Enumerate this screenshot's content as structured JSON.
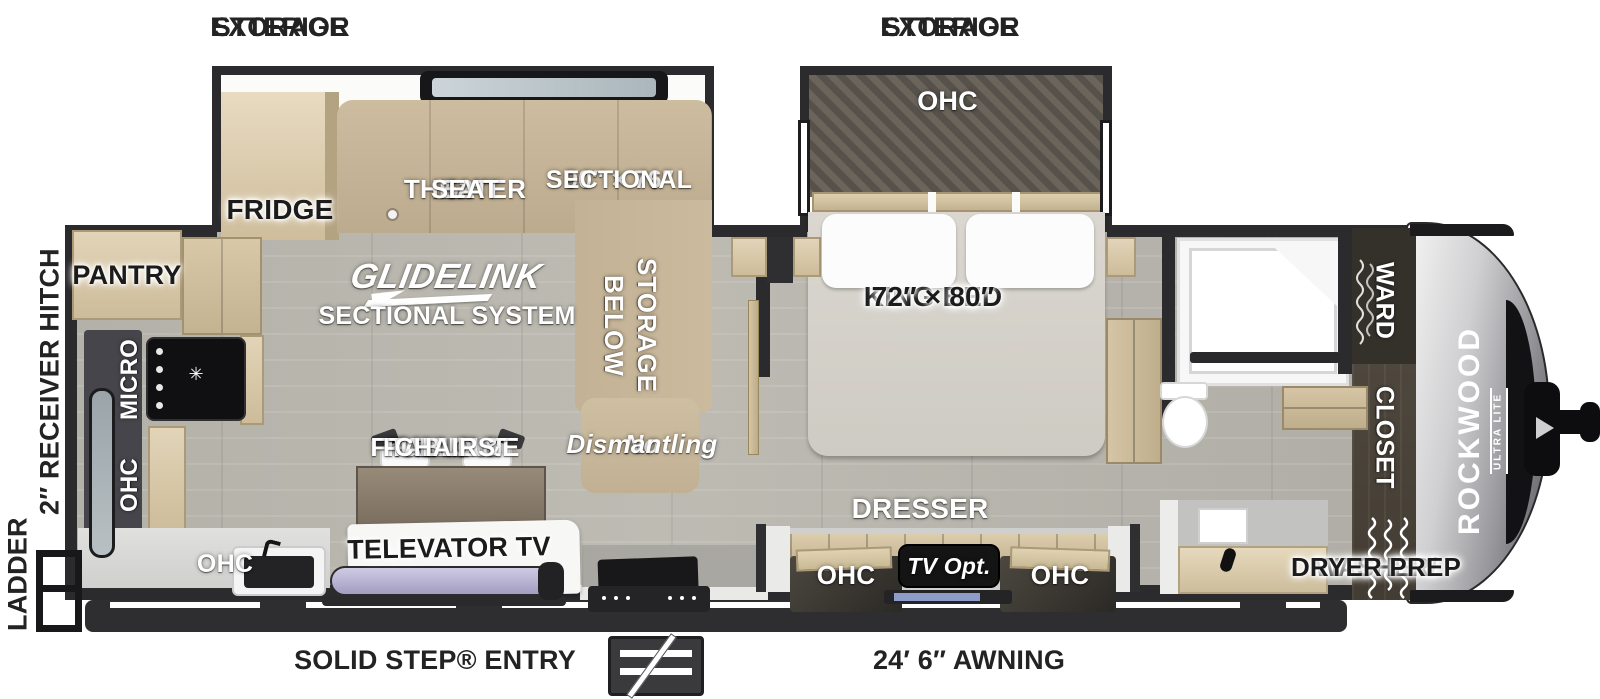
{
  "colors": {
    "wall": "#2b2b2d",
    "floor": "#b5b2aa",
    "wood": "#d7c8aa",
    "wood_dark": "#b4a381",
    "sofa_tan": "#c8b79b",
    "bed_gray": "#d7d3cb",
    "cap_silver": "#cfcfd1",
    "cap_window": "#121214",
    "label_black": "#232323",
    "label_white": "#ffffff",
    "tv_screen": "#b9b3d6"
  },
  "exterior": {
    "storage_left": [
      "EXTERIOR",
      "STORAGE"
    ],
    "storage_right": [
      "EXTERIOR",
      "STORAGE"
    ],
    "ladder": "LADDER",
    "receiver_hitch": "2″ RECEIVER HITCH",
    "solid_step": "SOLID STEP® ENTRY",
    "awning": "24′ 6″ AWNING"
  },
  "living": {
    "fridge": "FRIDGE",
    "pantry": "PANTRY",
    "theater_seat": [
      "52″",
      "THEATER",
      "SEAT"
    ],
    "sectional": [
      "90″ × 76″",
      "SECTIONAL"
    ],
    "glidelink": "GLIDELINK",
    "glidelink_sub": "SECTIONAL SYSTEM",
    "storage_below": [
      "STORAGE",
      "BELOW"
    ],
    "no_dismantling": [
      "No",
      "Dismantling"
    ],
    "fireplace": [
      "FIREPLACE",
      "PULLOUT",
      "TABLE &",
      "CHAIRS"
    ],
    "televator": "TELEVATOR TV",
    "micro": "MICRO",
    "ohc_wall": "OHC",
    "ohc_sink": "OHC"
  },
  "bedroom": {
    "ohc": "OHC",
    "king_bed": [
      "KING BED",
      "72″ × 80″"
    ],
    "dresser": "DRESSER",
    "ohc_left": "OHC",
    "tv_opt": "TV Opt.",
    "ohc_right": "OHC"
  },
  "bath": {
    "ward": "WARD",
    "closet": "CLOSET",
    "washer_dryer": [
      "WASHER/",
      "DRYER PREP"
    ]
  },
  "brand": {
    "name": "ROCKWOOD",
    "sub": "ULTRA LITE"
  }
}
